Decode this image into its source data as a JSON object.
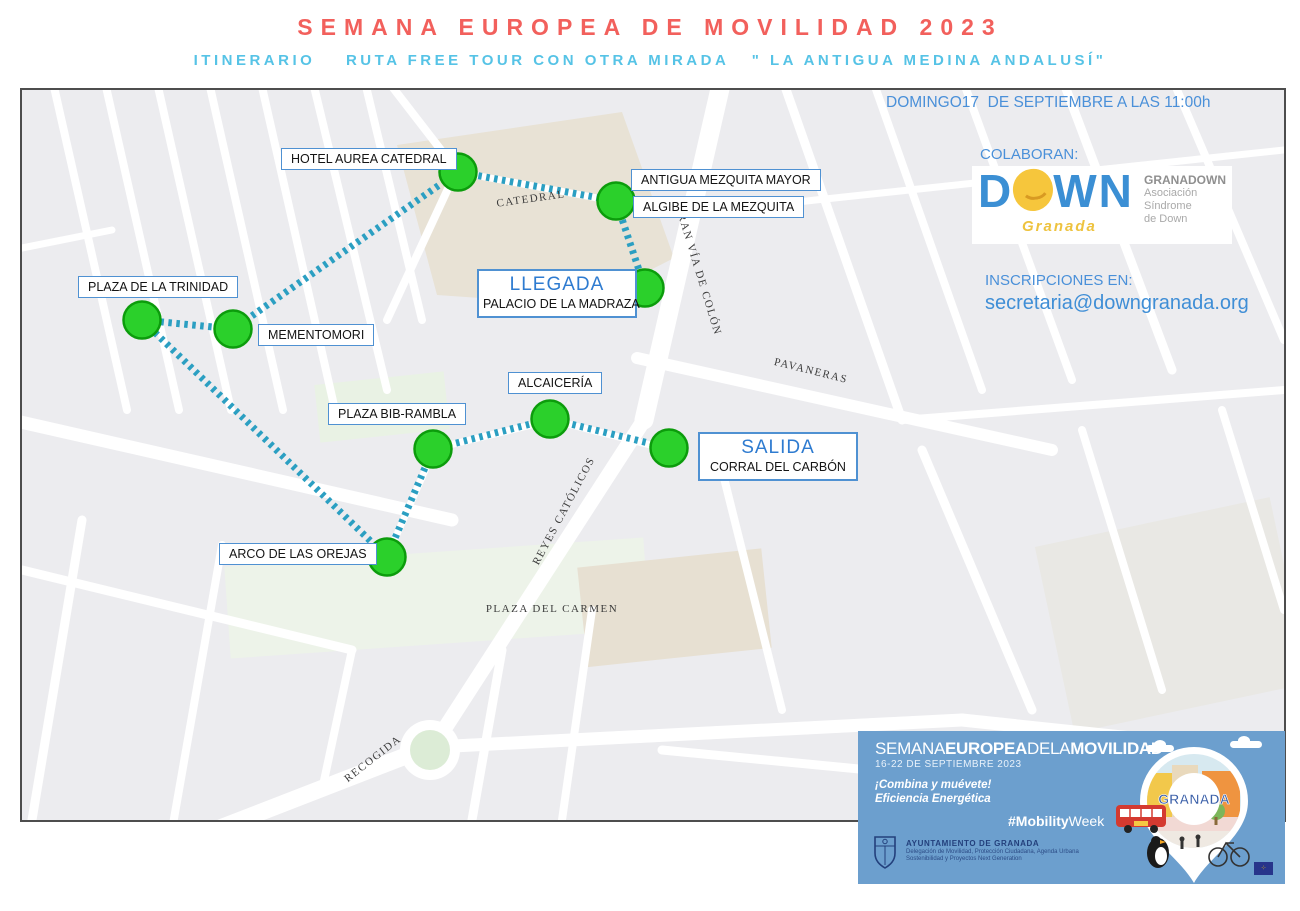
{
  "header": {
    "title": "SEMANA EUROPEA DE MOVILIDAD 2023",
    "subtitle": "ITINERARIO    RUTA FREE TOUR CON OTRA MIRADA   \" LA ANTIGUA MEDINA ANDALUSÍ\""
  },
  "event": {
    "datetime": "DOMINGO17  DE SEPTIEMBRE A LAS 11:00h",
    "colaboran_label": "COLABORAN:",
    "inscripciones_label": "INSCRIPCIONES EN:",
    "inscripciones_email": "secretaria@downgranada.org"
  },
  "logo": {
    "letter_d": "D",
    "letters_wn": "WN",
    "granada": "Granada",
    "org": "GRANADOWN",
    "line1": "Asociación",
    "line2": "Síndrome",
    "line3": "de Down"
  },
  "colors": {
    "title_red": "#f2605c",
    "subtitle_blue": "#56c3e6",
    "link_blue": "#4a90d9",
    "route_teal": "#2b9fc2",
    "marker_green": "#2bd02b",
    "marker_border": "#0c9c0c",
    "label_border_blue": "#4f91d2",
    "banner_blue": "#6c9fce"
  },
  "map": {
    "labels": [
      {
        "text": "HOTEL AUREA CATEDRAL",
        "x": 279,
        "y": 146
      },
      {
        "text": "ANTIGUA MEZQUITA MAYOR",
        "x": 629,
        "y": 167
      },
      {
        "text": "ALGIBE DE LA MEZQUITA",
        "x": 631,
        "y": 194
      },
      {
        "text": "PLAZA DE LA TRINIDAD",
        "x": 76,
        "y": 274
      },
      {
        "text": "MEMENTOMORI",
        "x": 256,
        "y": 322
      },
      {
        "text": "ALCAICERÍA",
        "x": 506,
        "y": 370
      },
      {
        "text": "PLAZA BIB-RAMBLA",
        "x": 326,
        "y": 401
      },
      {
        "text": "ARCO DE LAS OREJAS",
        "x": 217,
        "y": 541
      }
    ],
    "big_labels": [
      {
        "title": "LLEGADA",
        "sub": "PALACIO DE LA MADRAZA",
        "x": 475,
        "y": 267,
        "w": 148
      },
      {
        "title": "SALIDA",
        "sub": "CORRAL DEL CARBÓN",
        "x": 696,
        "y": 430,
        "w": 148
      }
    ],
    "markers": [
      {
        "x": 456,
        "y": 170
      },
      {
        "x": 614,
        "y": 199
      },
      {
        "x": 643,
        "y": 286
      },
      {
        "x": 140,
        "y": 318
      },
      {
        "x": 231,
        "y": 327
      },
      {
        "x": 548,
        "y": 417
      },
      {
        "x": 431,
        "y": 447
      },
      {
        "x": 667,
        "y": 446
      },
      {
        "x": 385,
        "y": 555
      }
    ],
    "route_points": "647,358 528,329 411,359 365,467 120,230 211,239 436,82 594,111 623,198",
    "streets": [
      {
        "text": "CATEDRAL",
        "x": 529,
        "y": 197,
        "rot": -8
      },
      {
        "text": "GRAN VÍA DE COLÓN",
        "x": 696,
        "y": 268,
        "rot": 73
      },
      {
        "text": "PAVANERAS",
        "x": 809,
        "y": 369,
        "rot": 14
      },
      {
        "text": "REYES CATÓLICOS",
        "x": 562,
        "y": 509,
        "rot": -62
      },
      {
        "text": "PLAZA DEL CARMEN",
        "x": 550,
        "y": 607,
        "rot": 0
      },
      {
        "text": "RECOGIDA",
        "x": 371,
        "y": 757,
        "rot": -38
      }
    ]
  },
  "banner": {
    "title_parts": [
      "SEMANA",
      "EUROPEA",
      "DELA",
      "MOVILIDAD"
    ],
    "dates": "16-22 DE SEPTIEMBRE 2023",
    "tagline1": "¡Combina y muévete!",
    "tagline2": "Eficiencia Energética",
    "hashtag_bold": "#Mobility",
    "hashtag_rest": "Week",
    "ayto": "AYUNTAMIENTO DE GRANADA",
    "ayto_line1": "Delegación de Movilidad, Protección Ciudadana, Agenda Urbana",
    "ayto_line2": "Sostenibilidad y Proyectos Next Generation",
    "pin_text": "GRANADA",
    "eu_stars": "⁘"
  }
}
